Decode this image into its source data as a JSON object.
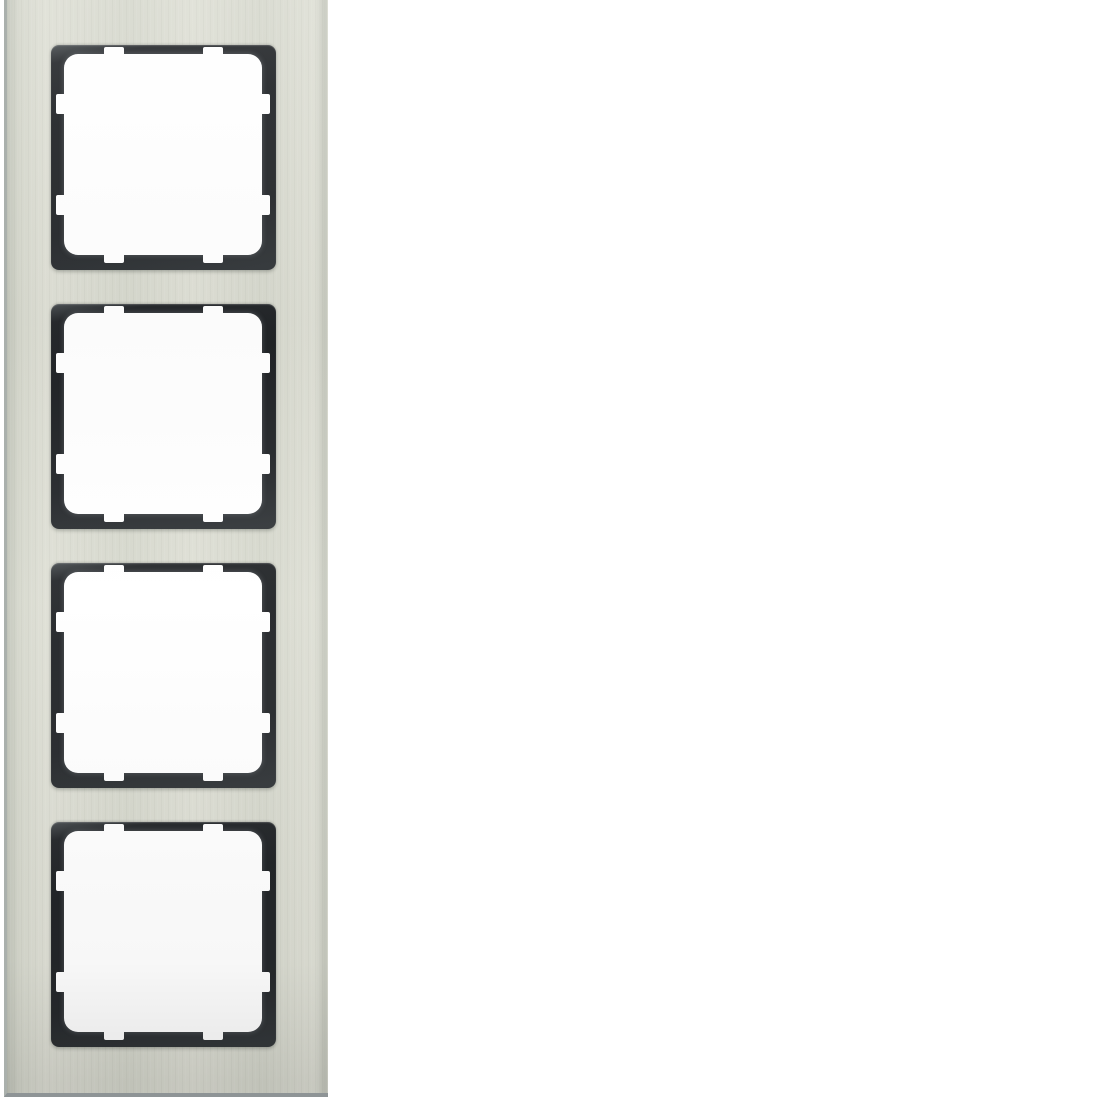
{
  "scene": {
    "kind": "product-photo",
    "subject": "vertical 4-gang electrical cover frame, stainless-steel finish with anthracite window inserts",
    "gang_count": 4,
    "orientation": "vertical",
    "tabs_per_window": 8,
    "visible_text": ""
  },
  "colors": {
    "background": "#ffffff",
    "plate": "#d6d8cd",
    "plate_light": "#dedfd5",
    "plate_shade": "#c3c6bb",
    "plate_edge_left": "#aab0ac",
    "plate_edge_bottom": "#8e9496",
    "insert_dark": "#26292c",
    "insert_highlight": "#4b5053",
    "window_fill": "#ffffff"
  }
}
